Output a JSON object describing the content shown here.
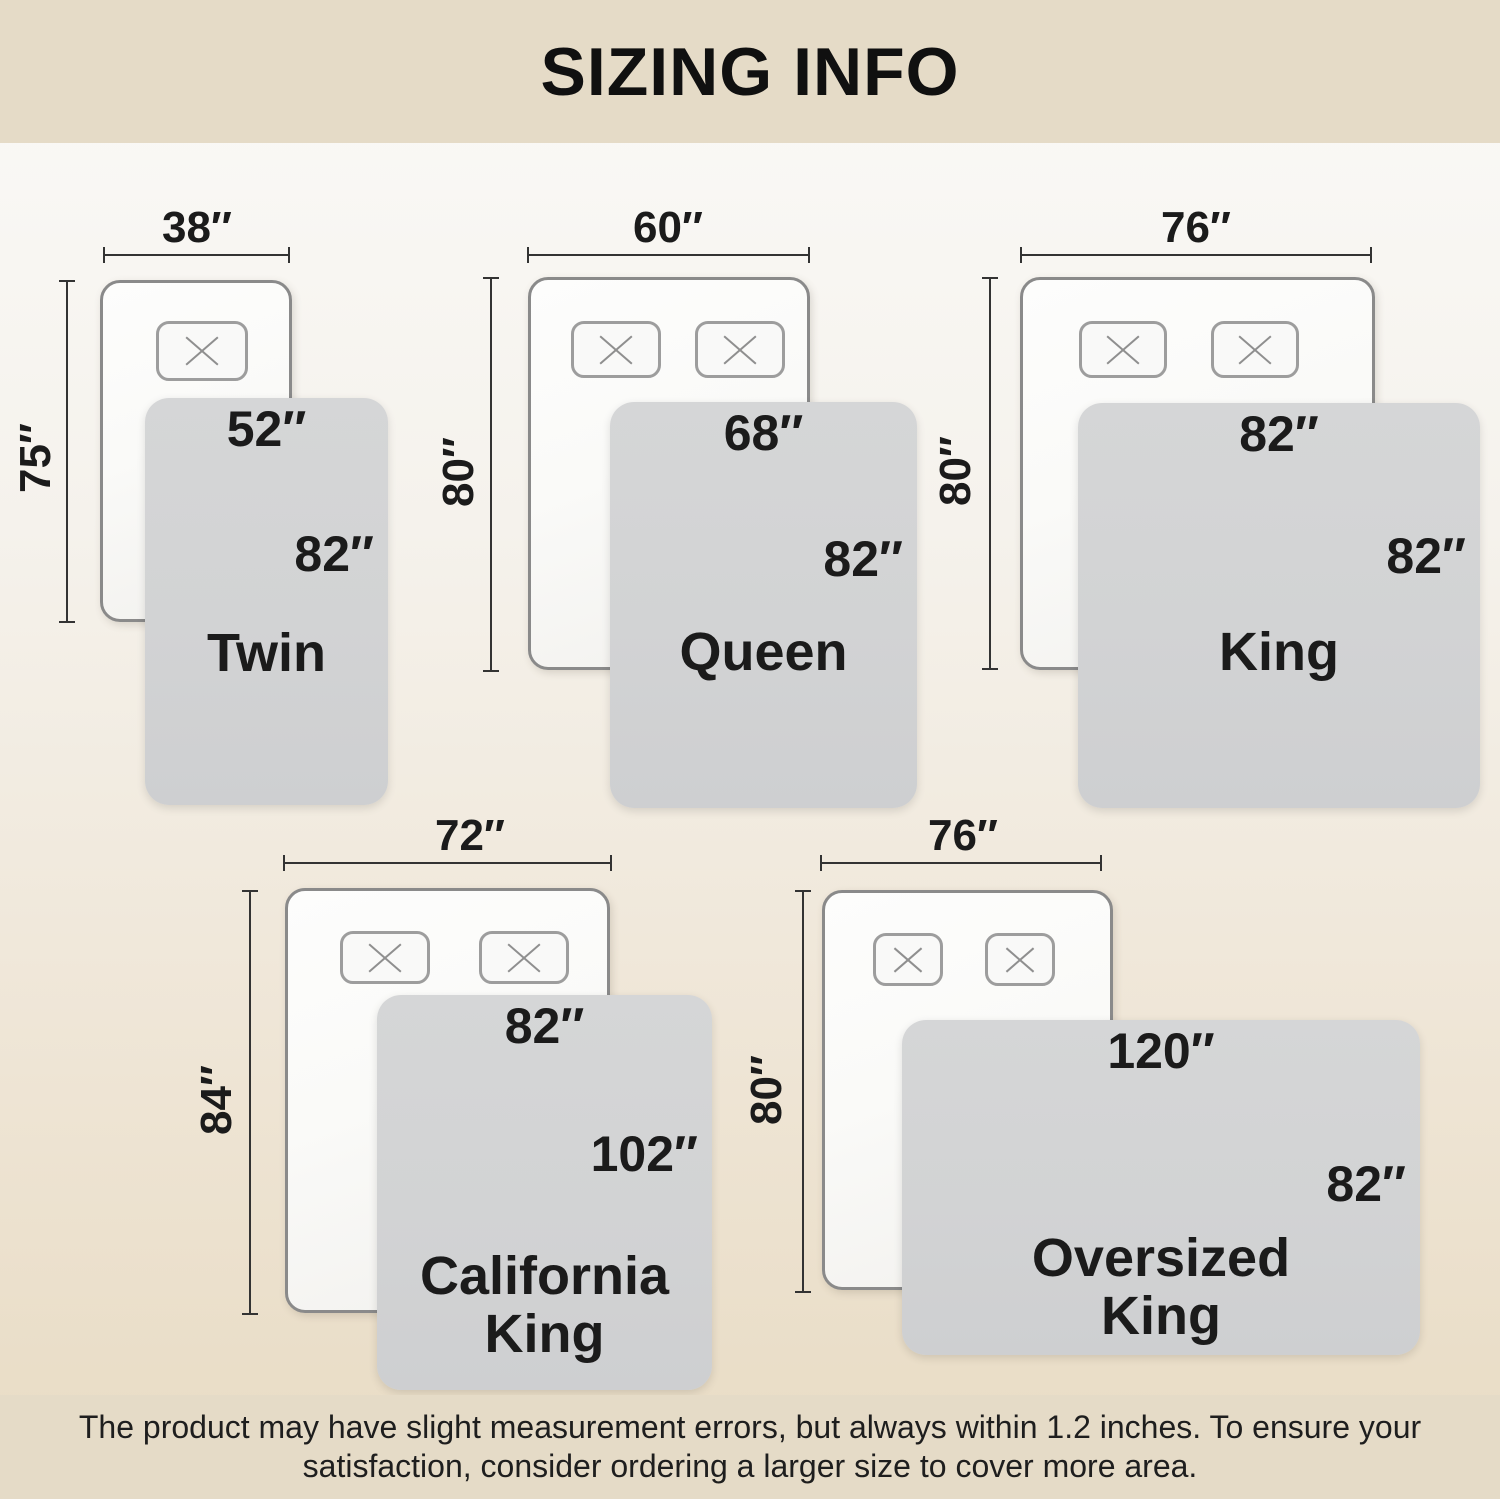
{
  "title": "SIZING INFO",
  "disclaimer": {
    "line1": "The product may have slight measurement errors, but always within 1.2 inches. To ensure your",
    "line2": "satisfaction, consider ordering a larger size to cover more area."
  },
  "colors": {
    "banner_bg": "#e5dbc7",
    "page_top": "#fbfaf8",
    "page_bottom": "#e8dbc3",
    "mattress_fill": "#fafaf8",
    "mattress_border": "#8a8a8a",
    "pillow_border": "#9d9d9d",
    "blanket_fill": "#d2d3d4",
    "dim_line": "#333333",
    "text_dark": "#1b1b1b"
  },
  "beds": [
    {
      "name": "Twin",
      "mattress_width": "38″",
      "mattress_length": "75″",
      "blanket_width": "52″",
      "blanket_length": "82″"
    },
    {
      "name": "Queen",
      "mattress_width": "60″",
      "mattress_length": "80″",
      "blanket_width": "68″",
      "blanket_length": "82″"
    },
    {
      "name": "King",
      "mattress_width": "76″",
      "mattress_length": "80″",
      "blanket_width": "82″",
      "blanket_length": "82″"
    },
    {
      "name": "California King",
      "mattress_width": "72″",
      "mattress_length": "84″",
      "blanket_width": "82″",
      "blanket_length": "102″"
    },
    {
      "name": "Oversized King",
      "mattress_width": "76″",
      "mattress_length": "80″",
      "blanket_width": "120″",
      "blanket_length": "82″"
    }
  ]
}
